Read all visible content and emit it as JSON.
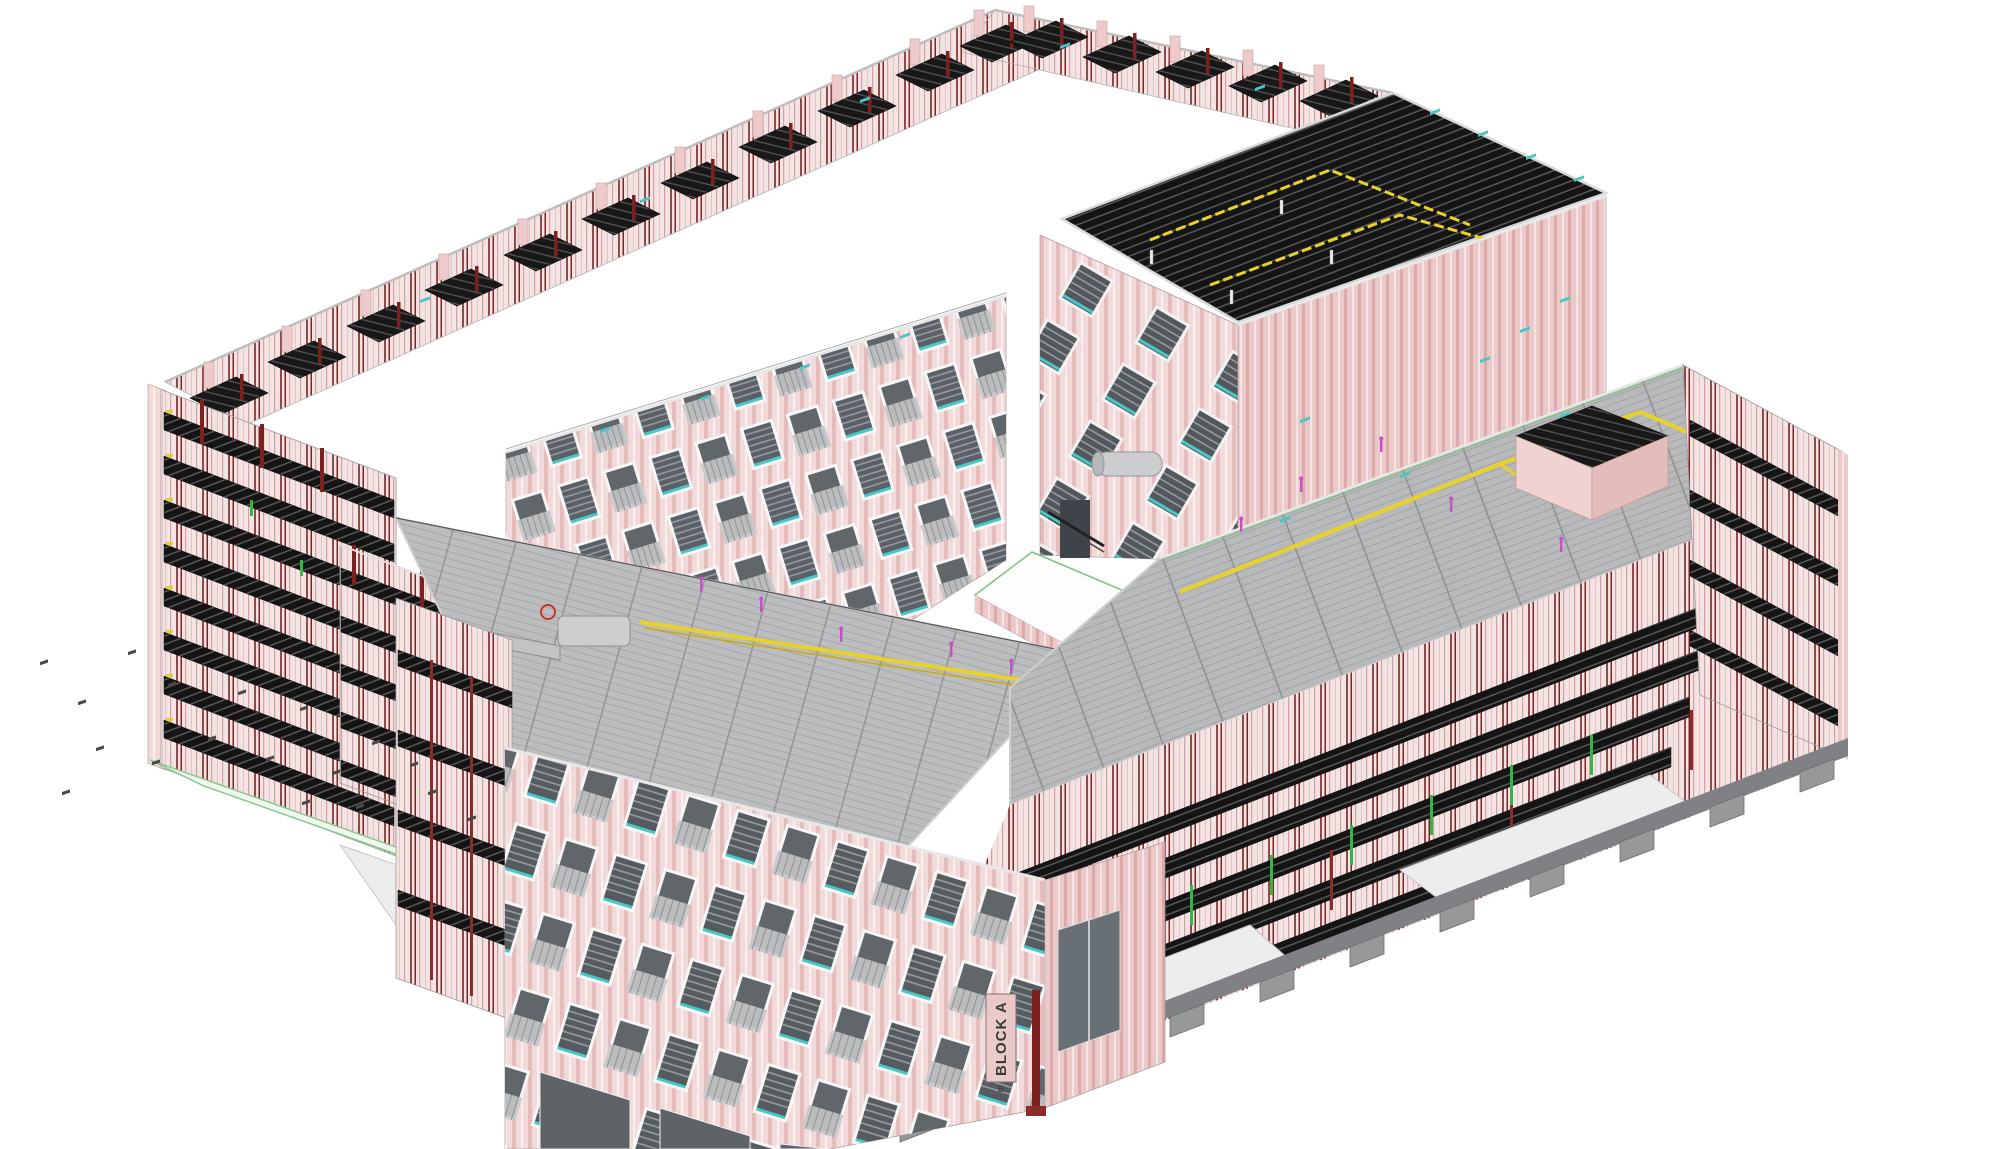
{
  "scene": {
    "background": "#ffffff",
    "block_label": {
      "text": "BLOCK A",
      "sub": "B"
    },
    "palette": {
      "facade_pink": "#f2dada",
      "facade_stripe": "#e5bcbc",
      "facade_pink_shaded": "#ecc9c9",
      "stud_wall": "#f4e3e3",
      "deck_dark": "#141414",
      "deck_stripe": "#5d5d5d",
      "roof_gray": "#b8b9bb",
      "roof_seam": "#8c8d8f",
      "conduit_yellow": "#e8d22a",
      "accent_teal": "#49c6c6",
      "accent_green": "#2fb848",
      "accent_magenta": "#c94fc9",
      "column_red": "#7c2020",
      "footing_gray": "#97989a",
      "ground_slab_green_edge": "#8cc98c",
      "glass_dark": "#5a6065",
      "frame_white": "#f7f7f7",
      "sign_bg": "#e9c9c9"
    }
  }
}
